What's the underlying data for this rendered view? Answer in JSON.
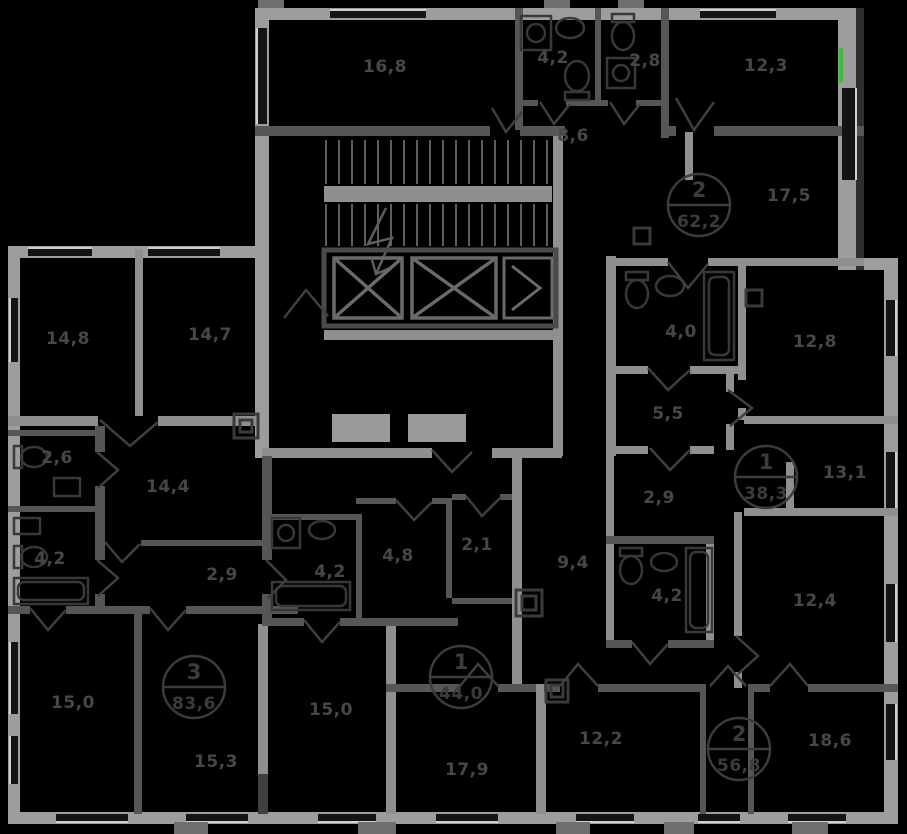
{
  "plan": {
    "canvas": {
      "width": 907,
      "height": 834
    },
    "colors": {
      "background": "#000000",
      "label_text": "#474747",
      "badge": "#3c3c3c",
      "highlight_green": "#2fc52f",
      "wall_light": "#9d9d9d",
      "wall_mid": "#8f8f8f",
      "wall_partition": "#565656",
      "wall_core": "#4a4a4a",
      "door": "#3f3f3f",
      "fixture": "#383838",
      "stair": "#5e5e5e",
      "window_glass": "#141414",
      "window_sill": "#d0d0d0",
      "balcony_stub": "#6f6f6f"
    },
    "room_labels": [
      {
        "label": "16,8",
        "x": 385,
        "y": 72
      },
      {
        "label": "4,2",
        "x": 553,
        "y": 63
      },
      {
        "label": "2,8",
        "x": 645,
        "y": 66
      },
      {
        "label": "12,3",
        "x": 766,
        "y": 71
      },
      {
        "label": "8,6",
        "x": 573,
        "y": 141
      },
      {
        "label": "17,5",
        "x": 789,
        "y": 201
      },
      {
        "label": "4,0",
        "x": 681,
        "y": 337
      },
      {
        "label": "12,8",
        "x": 815,
        "y": 347
      },
      {
        "label": "5,5",
        "x": 668,
        "y": 419
      },
      {
        "label": "14,8",
        "x": 68,
        "y": 344
      },
      {
        "label": "14,7",
        "x": 210,
        "y": 340
      },
      {
        "label": "2,9",
        "x": 659,
        "y": 503
      },
      {
        "label": "13,1",
        "x": 845,
        "y": 478
      },
      {
        "label": "2,6",
        "x": 57,
        "y": 463
      },
      {
        "label": "14,4",
        "x": 168,
        "y": 492
      },
      {
        "label": "4,2",
        "x": 50,
        "y": 564
      },
      {
        "label": "2,9",
        "x": 222,
        "y": 580
      },
      {
        "label": "4,2",
        "x": 330,
        "y": 577
      },
      {
        "label": "4,8",
        "x": 398,
        "y": 561
      },
      {
        "label": "2,1",
        "x": 477,
        "y": 550
      },
      {
        "label": "9,4",
        "x": 573,
        "y": 568
      },
      {
        "label": "4,2",
        "x": 667,
        "y": 601
      },
      {
        "label": "12,4",
        "x": 815,
        "y": 606
      },
      {
        "label": "15,0",
        "x": 73,
        "y": 708
      },
      {
        "label": "15,3",
        "x": 216,
        "y": 767
      },
      {
        "label": "15,0",
        "x": 331,
        "y": 715
      },
      {
        "label": "17,9",
        "x": 467,
        "y": 775
      },
      {
        "label": "12,2",
        "x": 601,
        "y": 744
      },
      {
        "label": "18,6",
        "x": 830,
        "y": 746
      }
    ],
    "apartments": [
      {
        "room_count": "2",
        "area": "62,2",
        "cx": 699,
        "cy": 205
      },
      {
        "room_count": "1",
        "area": "38,3",
        "cx": 766,
        "cy": 477
      },
      {
        "room_count": "1",
        "area": "44,0",
        "cx": 461,
        "cy": 677
      },
      {
        "room_count": "3",
        "area": "83,6",
        "cx": 194,
        "cy": 687
      },
      {
        "room_count": "2",
        "area": "56,8",
        "cx": 739,
        "cy": 749
      }
    ]
  }
}
